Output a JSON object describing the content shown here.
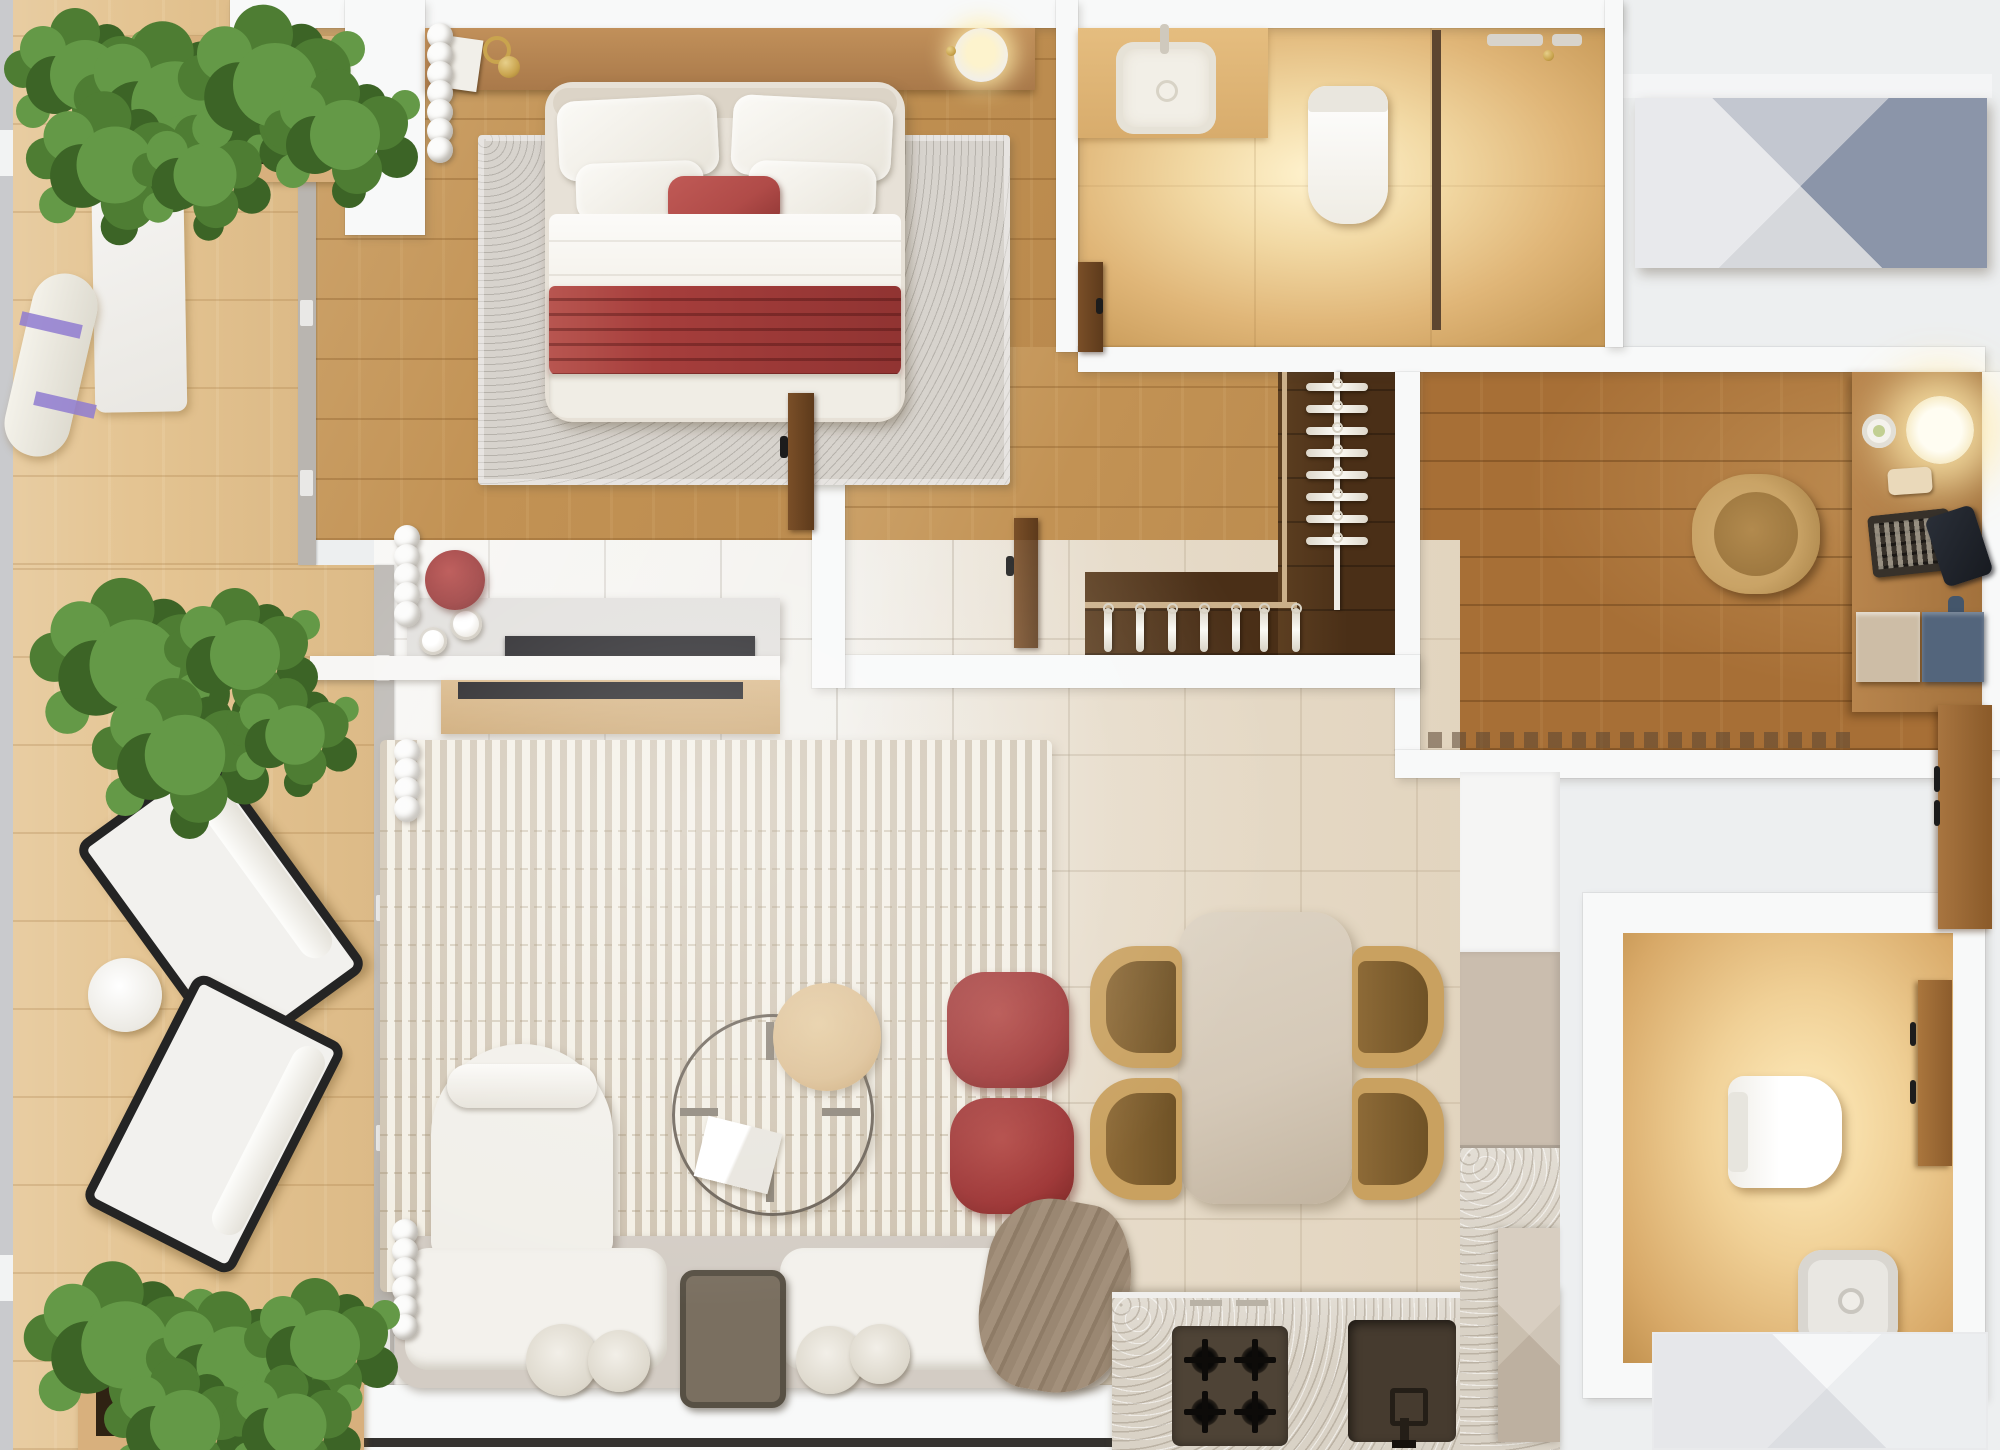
{
  "meta": {
    "view": "apartment-floor-plan-top-down-render",
    "canvas": {
      "width": 2000,
      "height": 1450
    }
  },
  "palette": {
    "bg": "#edeff0",
    "wall": "#f8f9f9",
    "tile": "#f0eee9",
    "tileline": "rgba(120,108,90,0.30)",
    "deck": "#e4c492",
    "oak": "#c29254",
    "office": "#a76f36",
    "closet": "#4a2f17",
    "marble_glow": "#fff3cf",
    "travertine": "#d9d2c6",
    "rug_bed": "#d7d3cd",
    "rug_living": "#f3efe5",
    "sofa_base": "#d3ccc4",
    "cream": "#f3f1ec",
    "red_blanket": "#a63e3c",
    "red_pillow": "#b04b48",
    "red_pouf": "#9e3636",
    "red_stool": "#993737",
    "tan_chair": "#c9a160",
    "tan_seat": "#8d6a37",
    "stone_table": "#d5c9b8",
    "hob": "#4e4336",
    "sink_dark": "#463b2f",
    "taupe_cabinet": "#cabdae",
    "blue_drawer": "#53657c",
    "facet_top": "#c3c7d0",
    "facet_right": "#8b95a9",
    "facet_bottom": "#d6d8dc",
    "facet_left": "#e8e9ec",
    "gold": "#c9a44e",
    "purple_strap": "#8f7bd0",
    "green1": "#4e7d33",
    "green2": "#649947",
    "green3": "#3c6426",
    "wood_door": "#9c6a38",
    "wood_console": "#b5854e",
    "wood_cabinet": "#d8b583",
    "tv_black": "#17161a"
  },
  "rooms": [
    {
      "id": "balcony",
      "label": "Balcony terrace",
      "items": [
        "planter box with shrubs (top)",
        "white exercise mat",
        "rolled mat with purple straps",
        "shrub cluster (middle)",
        "two black-frame lounge chairs",
        "round side table",
        "planter box with shrubs (bottom)"
      ]
    },
    {
      "id": "bedroom",
      "label": "Bedroom",
      "items": [
        "double bed with white bedding",
        "red accent pillow",
        "red pleated throw",
        "grey area rug",
        "headboard console with book and brass lamps",
        "bowl lamp",
        "white wardrobe volume",
        "scalloped curtain",
        "double-sided TV console",
        "red dressing stool",
        "two white cups"
      ]
    },
    {
      "id": "bathroom",
      "label": "Main bathroom",
      "items": [
        "vanity counter with basin",
        "wall-hung toilet",
        "shower partition",
        "shower fittings"
      ]
    },
    {
      "id": "closet",
      "label": "Walk-in closet",
      "items": [
        "vertical hanging rail with hangers",
        "lower hanging rail with hangers",
        "walnut floor"
      ]
    },
    {
      "id": "office",
      "label": "Home office",
      "items": [
        "desk with glowing lamp",
        "trinket dish",
        "smartphone",
        "keyboard",
        "dark notebook",
        "task chair",
        "drawer unit (beige + blue)",
        "floor vent strip"
      ]
    },
    {
      "id": "living",
      "label": "Living room",
      "items": [
        "white boucle corner sofa with chaise",
        "serving tray",
        "round pleated cushions",
        "knitted taupe throw",
        "glass ring coffee table",
        "timber disc side table",
        "white book",
        "two red poufs",
        "striped cream rug",
        "scalloped curtains"
      ]
    },
    {
      "id": "dining",
      "label": "Dining area",
      "items": [
        "stone dining table",
        "four tan dining chairs"
      ]
    },
    {
      "id": "kitchen",
      "label": "Kitchen",
      "items": [
        "travertine counter run",
        "four-burner hob",
        "undermount sink with faucet",
        "tall white cabinet",
        "taupe cabinet",
        "faceted dishwasher panel"
      ]
    },
    {
      "id": "powder",
      "label": "Guest bathroom",
      "items": [
        "wall-hung toilet",
        "square vessel sink",
        "timber vanity",
        "timber door with handles"
      ]
    },
    {
      "id": "exterior",
      "label": "Common area",
      "items": [
        "blue-grey faceted doormat",
        "white faceted mat"
      ]
    }
  ],
  "counts": {
    "curtain_bedroom": 7,
    "curtain_console": 5,
    "curtain_living_a": 4,
    "curtain_living_b": 6,
    "hangers_rail": 8,
    "hangers_bottom": 5,
    "hangers_bottom2": 2,
    "hob_burners": 4
  }
}
